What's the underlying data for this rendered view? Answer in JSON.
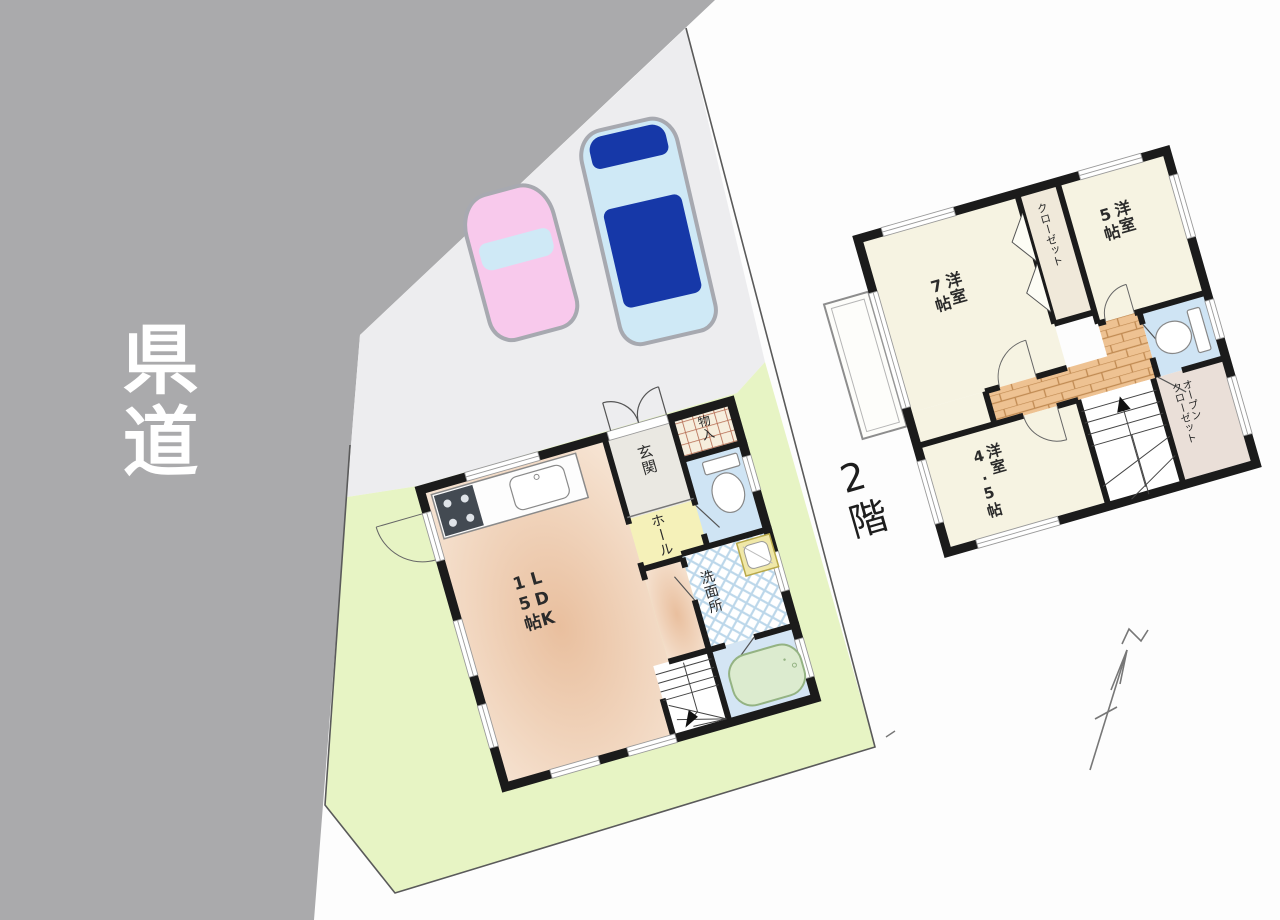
{
  "site": {
    "road_label": "県道",
    "floor2_caption": "2階"
  },
  "floor1": {
    "ldk_line1": "LDK",
    "ldk_line2": "15帖",
    "genkan": "玄関",
    "monoire": "物入",
    "hall": "ホール",
    "senmenjo": "洗面所"
  },
  "floor2": {
    "yoshitsu7_line1": "洋室",
    "yoshitsu7_line2": "7帖",
    "yoshitsu5_line1": "洋室",
    "yoshitsu5_line2": "5帖",
    "yoshitsu45_line1": "洋室",
    "yoshitsu45_line2": "4.5帖",
    "closet": "クローゼット",
    "open_closet_line1": "オープン",
    "open_closet_line2": "クローゼット"
  },
  "colors": {
    "road": "#aaaaac",
    "roadtext": "#ffffff",
    "parking": "#ededef",
    "yard": "#e7f4c4",
    "boundary": "#5a5a5a",
    "wall": "#1b1b1b",
    "room": "#f6f3e2",
    "hall": "#f5f1b9",
    "genkan": "#eae8e2",
    "wc": "#cfe4f4",
    "bath": "#d4e5f4",
    "tub": "#dcebcf",
    "tubline": "#94b383",
    "wood": "#eec292",
    "woodline": "#c08a52",
    "closet": "#f0e9da",
    "oc": "#eadfd8",
    "hatch": "#b4684e",
    "hatchbg": "#f6eedd",
    "lattice": "#bcd7ea",
    "carpink": "#f8c9ec",
    "carblue": "#1638a8",
    "carwin": "#cfe9f6",
    "cartrim": "#a7a9b0",
    "arrow": "#777777"
  }
}
